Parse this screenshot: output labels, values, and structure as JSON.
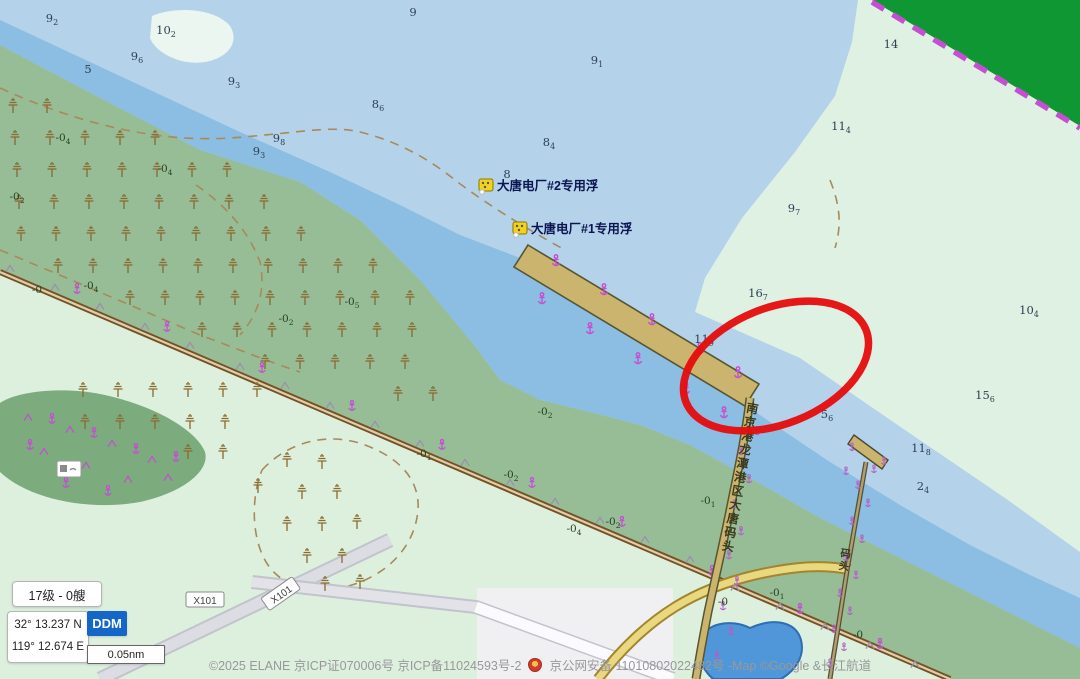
{
  "hud": {
    "level_chip": "17级 - 0艘",
    "lat": "32° 13.237 N",
    "lon": "119° 12.674 E",
    "mode": "DDM",
    "scale": "0.05nm"
  },
  "footer": {
    "part1": "©2025 ELANE 京ICP证070006号  京ICP备11024593号-2",
    "part2": "京公网安备 11010802022482号  -Map ©Google &长江航道"
  },
  "map": {
    "colors": {
      "water_light": "#b4d3ea",
      "water_channel": "#8cbde2",
      "shoal_mint": "#def1e3",
      "land_mid": "#97bd97",
      "land_pale": "#dcf0dd",
      "land_dark": "#0e9733",
      "pier_tan": "#cbb46d",
      "highlight_red": "#e60c0c",
      "magenta": "#c44fd0"
    },
    "buoys": [
      {
        "x": 479,
        "y": 179,
        "label": "大唐电厂#2专用浮"
      },
      {
        "x": 513,
        "y": 222,
        "label": "大唐电厂#1专用浮"
      }
    ],
    "pier_label": "南京港龙潭港区大唐码头",
    "small_pier_label": "码头",
    "road_label_text": "X101",
    "road_labels": [
      {
        "x": 205,
        "y": 600,
        "rot": 0
      },
      {
        "x": 281,
        "y": 594,
        "rot": -35
      }
    ],
    "soundings": [
      [
        52,
        22,
        "9",
        "2"
      ],
      [
        166,
        34,
        "10",
        "2"
      ],
      [
        137,
        60,
        "9",
        "6"
      ],
      [
        88,
        73,
        "5",
        ""
      ],
      [
        234,
        85,
        "9",
        "3"
      ],
      [
        413,
        16,
        "9",
        ""
      ],
      [
        279,
        142,
        "9",
        "8"
      ],
      [
        259,
        155,
        "9",
        "3"
      ],
      [
        378,
        108,
        "8",
        "6"
      ],
      [
        597,
        64,
        "9",
        "1"
      ],
      [
        549,
        146,
        "8",
        "4"
      ],
      [
        507,
        178,
        "8",
        ""
      ],
      [
        841,
        130,
        "11",
        "4"
      ],
      [
        891,
        48,
        "14",
        ""
      ],
      [
        794,
        212,
        "9",
        "7"
      ],
      [
        758,
        297,
        "16",
        "7"
      ],
      [
        704,
        343,
        "11",
        "9"
      ],
      [
        827,
        418,
        "5",
        "6"
      ],
      [
        1029,
        314,
        "10",
        "4"
      ],
      [
        985,
        399,
        "15",
        "6"
      ],
      [
        921,
        452,
        "11",
        "8"
      ],
      [
        923,
        490,
        "2",
        "4"
      ]
    ],
    "drying_labels": [
      [
        63,
        141,
        "4"
      ],
      [
        165,
        172,
        "4"
      ],
      [
        17,
        200,
        "2"
      ],
      [
        91,
        289,
        "4"
      ],
      [
        37,
        293,
        ""
      ],
      [
        286,
        322,
        "2"
      ],
      [
        352,
        305,
        "5"
      ],
      [
        545,
        415,
        "2"
      ],
      [
        424,
        457,
        "1"
      ],
      [
        511,
        478,
        "2"
      ],
      [
        613,
        525,
        "2"
      ],
      [
        574,
        532,
        "4"
      ],
      [
        708,
        504,
        "1"
      ],
      [
        723,
        605,
        ""
      ],
      [
        777,
        596,
        "1"
      ],
      [
        858,
        638,
        ""
      ]
    ],
    "symbols": {
      "marsh": [
        [
          13,
          106
        ],
        [
          47,
          106
        ],
        [
          15,
          138
        ],
        [
          50,
          138
        ],
        [
          85,
          138
        ],
        [
          120,
          138
        ],
        [
          155,
          138
        ],
        [
          17,
          170
        ],
        [
          52,
          170
        ],
        [
          87,
          170
        ],
        [
          122,
          170
        ],
        [
          157,
          170
        ],
        [
          192,
          170
        ],
        [
          227,
          170
        ],
        [
          19,
          202
        ],
        [
          54,
          202
        ],
        [
          89,
          202
        ],
        [
          124,
          202
        ],
        [
          159,
          202
        ],
        [
          194,
          202
        ],
        [
          229,
          202
        ],
        [
          264,
          202
        ],
        [
          21,
          234
        ],
        [
          56,
          234
        ],
        [
          91,
          234
        ],
        [
          126,
          234
        ],
        [
          161,
          234
        ],
        [
          196,
          234
        ],
        [
          231,
          234
        ],
        [
          266,
          234
        ],
        [
          301,
          234
        ],
        [
          58,
          266
        ],
        [
          93,
          266
        ],
        [
          128,
          266
        ],
        [
          163,
          266
        ],
        [
          198,
          266
        ],
        [
          233,
          266
        ],
        [
          268,
          266
        ],
        [
          303,
          266
        ],
        [
          338,
          266
        ],
        [
          373,
          266
        ],
        [
          130,
          298
        ],
        [
          165,
          298
        ],
        [
          200,
          298
        ],
        [
          235,
          298
        ],
        [
          270,
          298
        ],
        [
          305,
          298
        ],
        [
          340,
          298
        ],
        [
          375,
          298
        ],
        [
          410,
          298
        ],
        [
          202,
          330
        ],
        [
          237,
          330
        ],
        [
          272,
          330
        ],
        [
          307,
          330
        ],
        [
          342,
          330
        ],
        [
          377,
          330
        ],
        [
          412,
          330
        ],
        [
          265,
          362
        ],
        [
          300,
          362
        ],
        [
          335,
          362
        ],
        [
          370,
          362
        ],
        [
          405,
          362
        ],
        [
          398,
          394
        ],
        [
          433,
          394
        ],
        [
          83,
          390
        ],
        [
          118,
          390
        ],
        [
          153,
          390
        ],
        [
          188,
          390
        ],
        [
          223,
          390
        ],
        [
          257,
          390
        ],
        [
          85,
          422
        ],
        [
          120,
          422
        ],
        [
          155,
          422
        ],
        [
          190,
          422
        ],
        [
          225,
          422
        ],
        [
          188,
          452
        ],
        [
          223,
          452
        ],
        [
          258,
          486
        ],
        [
          287,
          460
        ],
        [
          322,
          462
        ],
        [
          302,
          492
        ],
        [
          337,
          492
        ],
        [
          287,
          524
        ],
        [
          322,
          524
        ],
        [
          357,
          522
        ],
        [
          307,
          556
        ],
        [
          342,
          556
        ],
        [
          325,
          584
        ],
        [
          360,
          582
        ]
      ],
      "levee_triangles": [
        [
          10,
          269
        ],
        [
          55,
          288
        ],
        [
          100,
          307
        ],
        [
          145,
          327
        ],
        [
          190,
          346
        ],
        [
          240,
          367
        ],
        [
          285,
          386
        ],
        [
          330,
          406
        ],
        [
          375,
          425
        ],
        [
          420,
          444
        ],
        [
          465,
          463
        ],
        [
          510,
          483
        ],
        [
          555,
          502
        ],
        [
          600,
          521
        ],
        [
          645,
          540
        ],
        [
          690,
          560
        ],
        [
          735,
          588
        ],
        [
          780,
          607
        ],
        [
          825,
          627
        ],
        [
          870,
          646
        ],
        [
          915,
          665
        ]
      ],
      "levee_anchors": [
        [
          77,
          290
        ],
        [
          167,
          328
        ],
        [
          262,
          369
        ],
        [
          352,
          407
        ],
        [
          442,
          446
        ],
        [
          532,
          484
        ],
        [
          622,
          523
        ],
        [
          712,
          572
        ],
        [
          800,
          610
        ],
        [
          880,
          645
        ]
      ],
      "spoil_triangles": [
        [
          28,
          418
        ],
        [
          70,
          430
        ],
        [
          112,
          444
        ],
        [
          152,
          460
        ],
        [
          44,
          452
        ],
        [
          86,
          466
        ],
        [
          128,
          480
        ],
        [
          168,
          478
        ]
      ],
      "spoil_anchors": [
        [
          52,
          420
        ],
        [
          94,
          434
        ],
        [
          136,
          450
        ],
        [
          176,
          458
        ],
        [
          66,
          484
        ],
        [
          108,
          492
        ],
        [
          30,
          446
        ]
      ],
      "pier_anchors": [
        [
          556,
          262
        ],
        [
          604,
          291
        ],
        [
          652,
          321
        ],
        [
          700,
          350
        ],
        [
          738,
          374
        ],
        [
          542,
          300
        ],
        [
          590,
          330
        ],
        [
          638,
          360
        ],
        [
          686,
          390
        ],
        [
          724,
          414
        ]
      ],
      "trestle_marks": [
        [
          757,
          432
        ],
        [
          741,
          452
        ],
        [
          749,
          480
        ],
        [
          735,
          505
        ],
        [
          741,
          532
        ],
        [
          729,
          556
        ],
        [
          737,
          582
        ],
        [
          723,
          607
        ],
        [
          731,
          632
        ],
        [
          717,
          657
        ]
      ],
      "trestle2_marks": [
        [
          874,
          470
        ],
        [
          858,
          486
        ],
        [
          868,
          504
        ],
        [
          852,
          522
        ],
        [
          862,
          540
        ],
        [
          846,
          558
        ],
        [
          856,
          576
        ],
        [
          840,
          594
        ],
        [
          850,
          612
        ],
        [
          834,
          630
        ],
        [
          844,
          648
        ],
        [
          830,
          664
        ],
        [
          852,
          448
        ],
        [
          884,
          462
        ],
        [
          846,
          472
        ]
      ]
    }
  }
}
